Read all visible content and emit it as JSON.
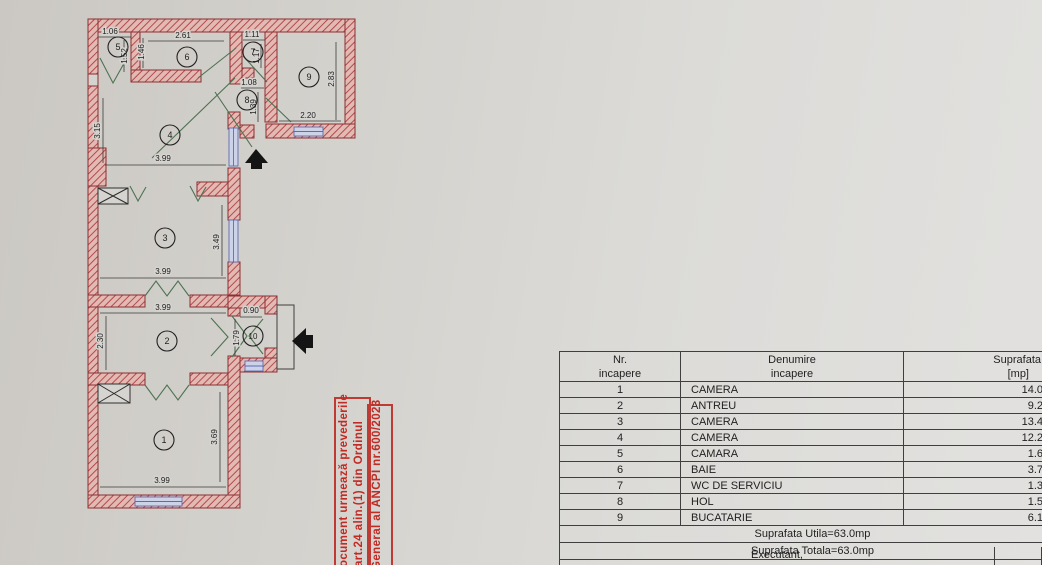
{
  "plan": {
    "colors": {
      "wall_line": "#8c2f32",
      "wall_hatch": "#a83a3c",
      "wall_fill": "#e3b9b3",
      "window_line": "#5f6bb0",
      "window_fill": "#ccd3e8",
      "door_line": "#4d7252",
      "dim_line": "#3b3b3b",
      "arrow": "#141414"
    },
    "rooms": [
      "1",
      "2",
      "3",
      "4",
      "5",
      "6",
      "7",
      "8",
      "9",
      "10"
    ],
    "dims": [
      "1.06",
      "1.52",
      "1.46",
      "2.61",
      "1.11",
      "1.17",
      "1.08",
      "1.39",
      "2.83",
      "2.20",
      "3.15",
      "3.99",
      "3.49",
      "3.99",
      "3.99",
      "2.30",
      "0.90",
      "1.79",
      "3.69",
      "3.99"
    ]
  },
  "stamp": {
    "color": "#c22a24",
    "lines": [
      "ocument urmează prevederile",
      "art.24  alin.(1)  din  Ordinul",
      "General al ANCPI nr.600/2023"
    ]
  },
  "table": {
    "header": {
      "col1_line1": "Nr.",
      "col1_line2": "incapere",
      "col2_line1": "Denumire",
      "col2_line2": "incapere",
      "col3_line1": "Suprafata",
      "col3_line2": "[mp]"
    },
    "rows": [
      {
        "nr": "1",
        "name": "CAMERA",
        "area": "14.0"
      },
      {
        "nr": "2",
        "name": "ANTREU",
        "area": "9.2"
      },
      {
        "nr": "3",
        "name": "CAMERA",
        "area": "13.4"
      },
      {
        "nr": "4",
        "name": "CAMERA",
        "area": "12.2"
      },
      {
        "nr": "5",
        "name": "CAMARA",
        "area": "1.6"
      },
      {
        "nr": "6",
        "name": "BAIE",
        "area": "3.7"
      },
      {
        "nr": "7",
        "name": "WC DE SERVICIU",
        "area": "1.3"
      },
      {
        "nr": "8",
        "name": "HOL",
        "area": "1.5"
      },
      {
        "nr": "9",
        "name": "BUCATARIE",
        "area": "6.1"
      }
    ],
    "totals": [
      "Suprafata Utila=63.0mp",
      "Suprafata Totala=63.0mp"
    ],
    "footer": "Executant,"
  }
}
